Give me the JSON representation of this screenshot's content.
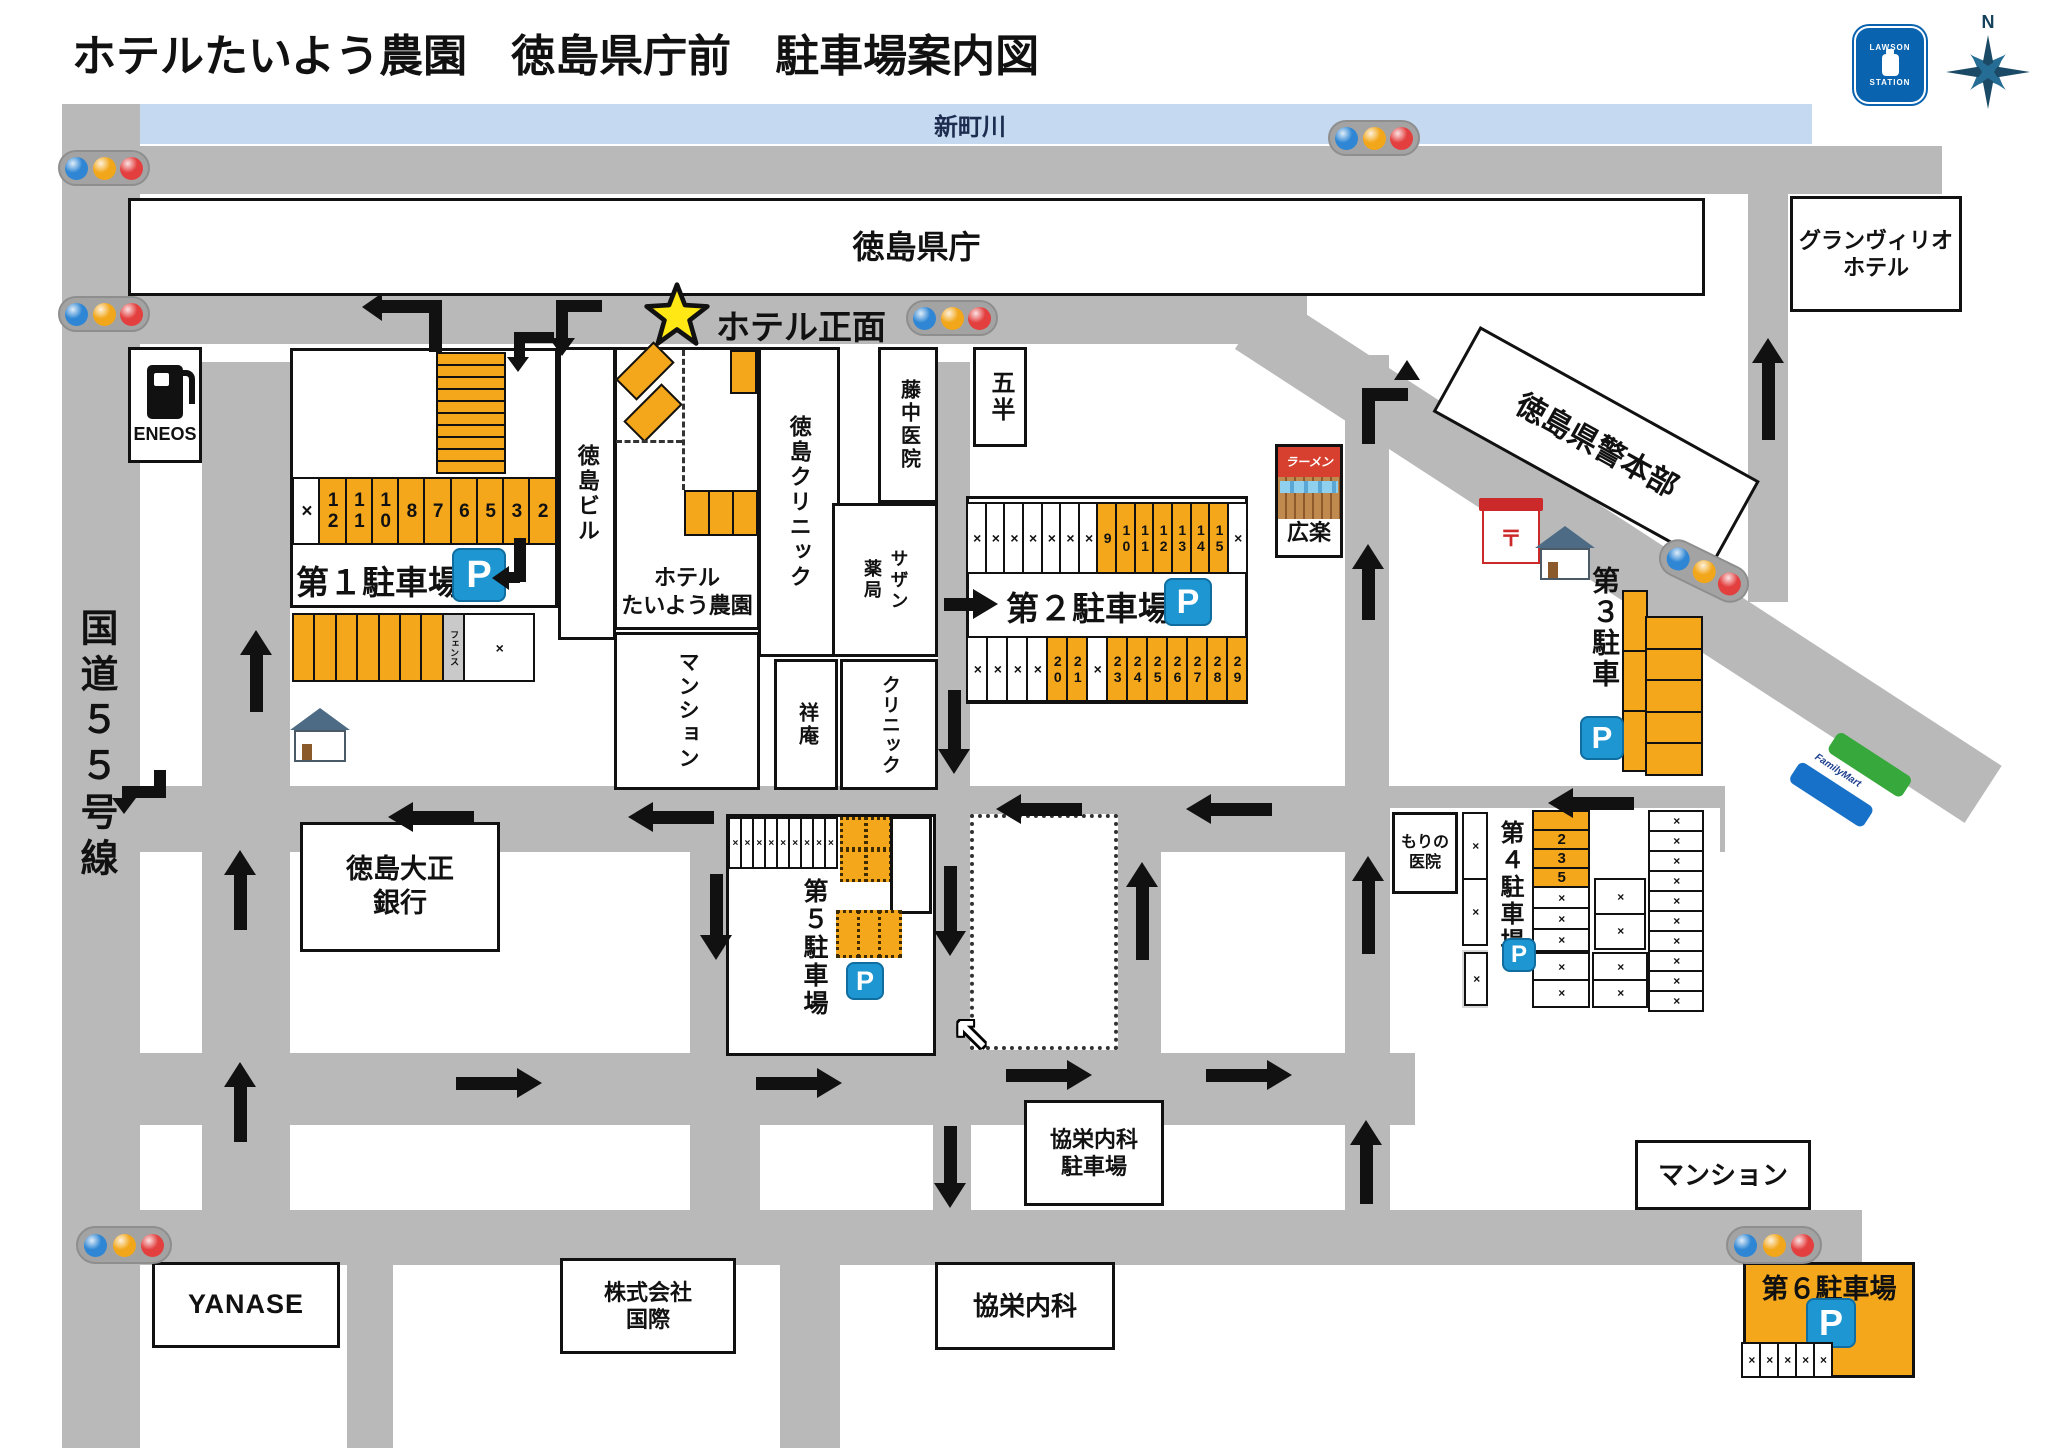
{
  "title": "ホテルたいよう農園　徳島県庁前　駐車場案内図",
  "labels": {
    "river": "新町川",
    "kencho": "徳島県庁",
    "granvrio1": "グランヴィリオ",
    "granvrio2": "ホテル",
    "keihonbu": "徳島県警本部",
    "eneos": "ENEOS",
    "kokudo": "国道５５号線",
    "tokushimabiru": "徳島ビル",
    "hotel1": "ホテル",
    "hotel2": "たいよう農園",
    "hotelfront": "ホテル正面",
    "tclinic": "徳島クリニック",
    "fujinaka": "藤中医院",
    "sazan1": "サザン",
    "sazan2": "薬局",
    "gohan": "五半",
    "mansion_center": "マンション",
    "shoan": "祥庵",
    "clinic": "クリニック",
    "koraku": "広楽",
    "ramen": "ラーメン",
    "bank1": "徳島大正",
    "bank2": "銀行",
    "morino1": "もりの",
    "morino2": "医院",
    "kyoei_parking1": "協栄内科",
    "kyoei_parking2": "駐車場",
    "mansion_se": "マンション",
    "yanase": "YANASE",
    "kokusai1": "株式会社",
    "kokusai2": "国際",
    "kyoei": "協栄内科",
    "lawson1": "LAWSON",
    "lawson2": "STATION",
    "familymart": "FamilyMart",
    "north": "N"
  },
  "icons": {
    "p": "P",
    "post": "〒",
    "nw_arrow": "↖"
  },
  "parking": {
    "p1": {
      "label": "第１駐車場",
      "stack": [
        {
          "t": "o"
        },
        {
          "t": "o"
        },
        {
          "t": "o"
        },
        {
          "t": "o"
        },
        {
          "t": "o"
        },
        {
          "t": "o"
        },
        {
          "t": "o"
        },
        {
          "t": "o"
        },
        {
          "t": "o"
        },
        {
          "t": "o"
        }
      ],
      "row": [
        {
          "n": "×",
          "t": "w"
        },
        {
          "n": "12",
          "t": "o"
        },
        {
          "n": "11",
          "t": "o"
        },
        {
          "n": "10",
          "t": "o"
        },
        {
          "n": "8",
          "t": "o"
        },
        {
          "n": "7",
          "t": "o"
        },
        {
          "n": "6",
          "t": "o"
        },
        {
          "n": "5",
          "t": "o"
        },
        {
          "n": "3",
          "t": "o"
        },
        {
          "n": "2",
          "t": "o"
        }
      ],
      "lower": [
        {
          "t": "o"
        },
        {
          "t": "o"
        },
        {
          "t": "o"
        },
        {
          "t": "o"
        },
        {
          "t": "o"
        },
        {
          "t": "o"
        },
        {
          "t": "o"
        },
        {
          "n": "フェンス",
          "t": "f"
        },
        {
          "n": "×",
          "t": "xw"
        }
      ]
    },
    "p2": {
      "label": "第２駐車場",
      "top": [
        {
          "n": "×"
        },
        {
          "n": "×"
        },
        {
          "n": "×"
        },
        {
          "n": "×"
        },
        {
          "n": "×"
        },
        {
          "n": "×"
        },
        {
          "n": "×"
        },
        {
          "n": "9",
          "t": "o"
        },
        {
          "n": "10",
          "t": "o"
        },
        {
          "n": "11",
          "t": "o"
        },
        {
          "n": "12",
          "t": "o"
        },
        {
          "n": "13",
          "t": "o"
        },
        {
          "n": "14",
          "t": "o"
        },
        {
          "n": "15",
          "t": "o"
        },
        {
          "n": "×"
        }
      ],
      "bottom": [
        {
          "n": "×"
        },
        {
          "n": "×"
        },
        {
          "n": "×"
        },
        {
          "n": "×"
        },
        {
          "n": "20",
          "t": "o"
        },
        {
          "n": "21",
          "t": "o"
        },
        {
          "n": "×"
        },
        {
          "n": "23",
          "t": "o"
        },
        {
          "n": "24",
          "t": "o"
        },
        {
          "n": "25",
          "t": "o"
        },
        {
          "n": "26",
          "t": "o"
        },
        {
          "n": "27",
          "t": "o"
        },
        {
          "n": "28",
          "t": "o"
        },
        {
          "n": "29",
          "t": "o"
        }
      ]
    },
    "p3": {
      "label": "第３駐車",
      "colA": [
        {
          "t": "o"
        },
        {
          "t": "o"
        },
        {
          "t": "o"
        }
      ],
      "colB": [
        {
          "t": "o"
        },
        {
          "t": "o"
        },
        {
          "t": "o"
        },
        {
          "t": "o"
        },
        {
          "t": "o"
        }
      ]
    },
    "p4": {
      "label": "第４駐車場",
      "orange": [
        {
          "n": "",
          "t": "o"
        },
        {
          "n": "2",
          "t": "o"
        },
        {
          "n": "3",
          "t": "o"
        },
        {
          "n": "5",
          "t": "o"
        }
      ],
      "below_orange": [
        {
          "n": "×"
        },
        {
          "n": "×"
        },
        {
          "n": "×"
        }
      ],
      "left_col": [
        {
          "n": "×"
        },
        {
          "n": "×"
        }
      ],
      "mid_col": [
        {
          "n": "×"
        },
        {
          "n": "×"
        }
      ],
      "right_col": [
        {
          "n": "×"
        },
        {
          "n": "×"
        },
        {
          "n": "×"
        },
        {
          "n": "×"
        },
        {
          "n": "×"
        },
        {
          "n": "×"
        },
        {
          "n": "×"
        },
        {
          "n": "×"
        },
        {
          "n": "×"
        },
        {
          "n": "×"
        }
      ],
      "low_a": [
        {
          "n": "×"
        },
        {
          "n": "×"
        }
      ],
      "low_b": [
        {
          "n": "×"
        },
        {
          "n": "×"
        }
      ],
      "gray_cell": [
        {
          "n": "×"
        }
      ]
    },
    "p5": {
      "label": "第５駐車場",
      "xrow": [
        {
          "n": "×"
        },
        {
          "n": "×"
        },
        {
          "n": "×"
        },
        {
          "n": "×"
        },
        {
          "n": "×"
        },
        {
          "n": "×"
        },
        {
          "n": "×"
        },
        {
          "n": "×"
        },
        {
          "n": "×"
        }
      ],
      "dashed_top1": [
        {
          "t": "od"
        },
        {
          "t": "od"
        }
      ],
      "dashed_top2": [
        {
          "t": "od"
        },
        {
          "t": "od"
        }
      ],
      "dashed_low": [
        {
          "t": "od"
        },
        {
          "t": "od"
        },
        {
          "t": "od"
        }
      ]
    },
    "p6": {
      "label": "第６駐車場",
      "cells": [
        {
          "n": "×"
        },
        {
          "n": "×"
        },
        {
          "n": "×"
        },
        {
          "n": "×"
        },
        {
          "n": "×"
        }
      ]
    }
  },
  "colors": {
    "parking_orange": "#f4a71b",
    "road_gray": "#b9b9b9",
    "river_blue": "#c5d9f0",
    "p_icon_blue": "#1e96d2",
    "signal_blue": "#2e86d4",
    "signal_amber": "#f2a71b",
    "signal_red": "#e33f3f",
    "lawson_blue": "#0a63ae",
    "familymart_green": "#37a93c",
    "familymart_blue": "#1871c8",
    "ramen_red": "#d7402e",
    "star_yellow": "#ffe813"
  }
}
